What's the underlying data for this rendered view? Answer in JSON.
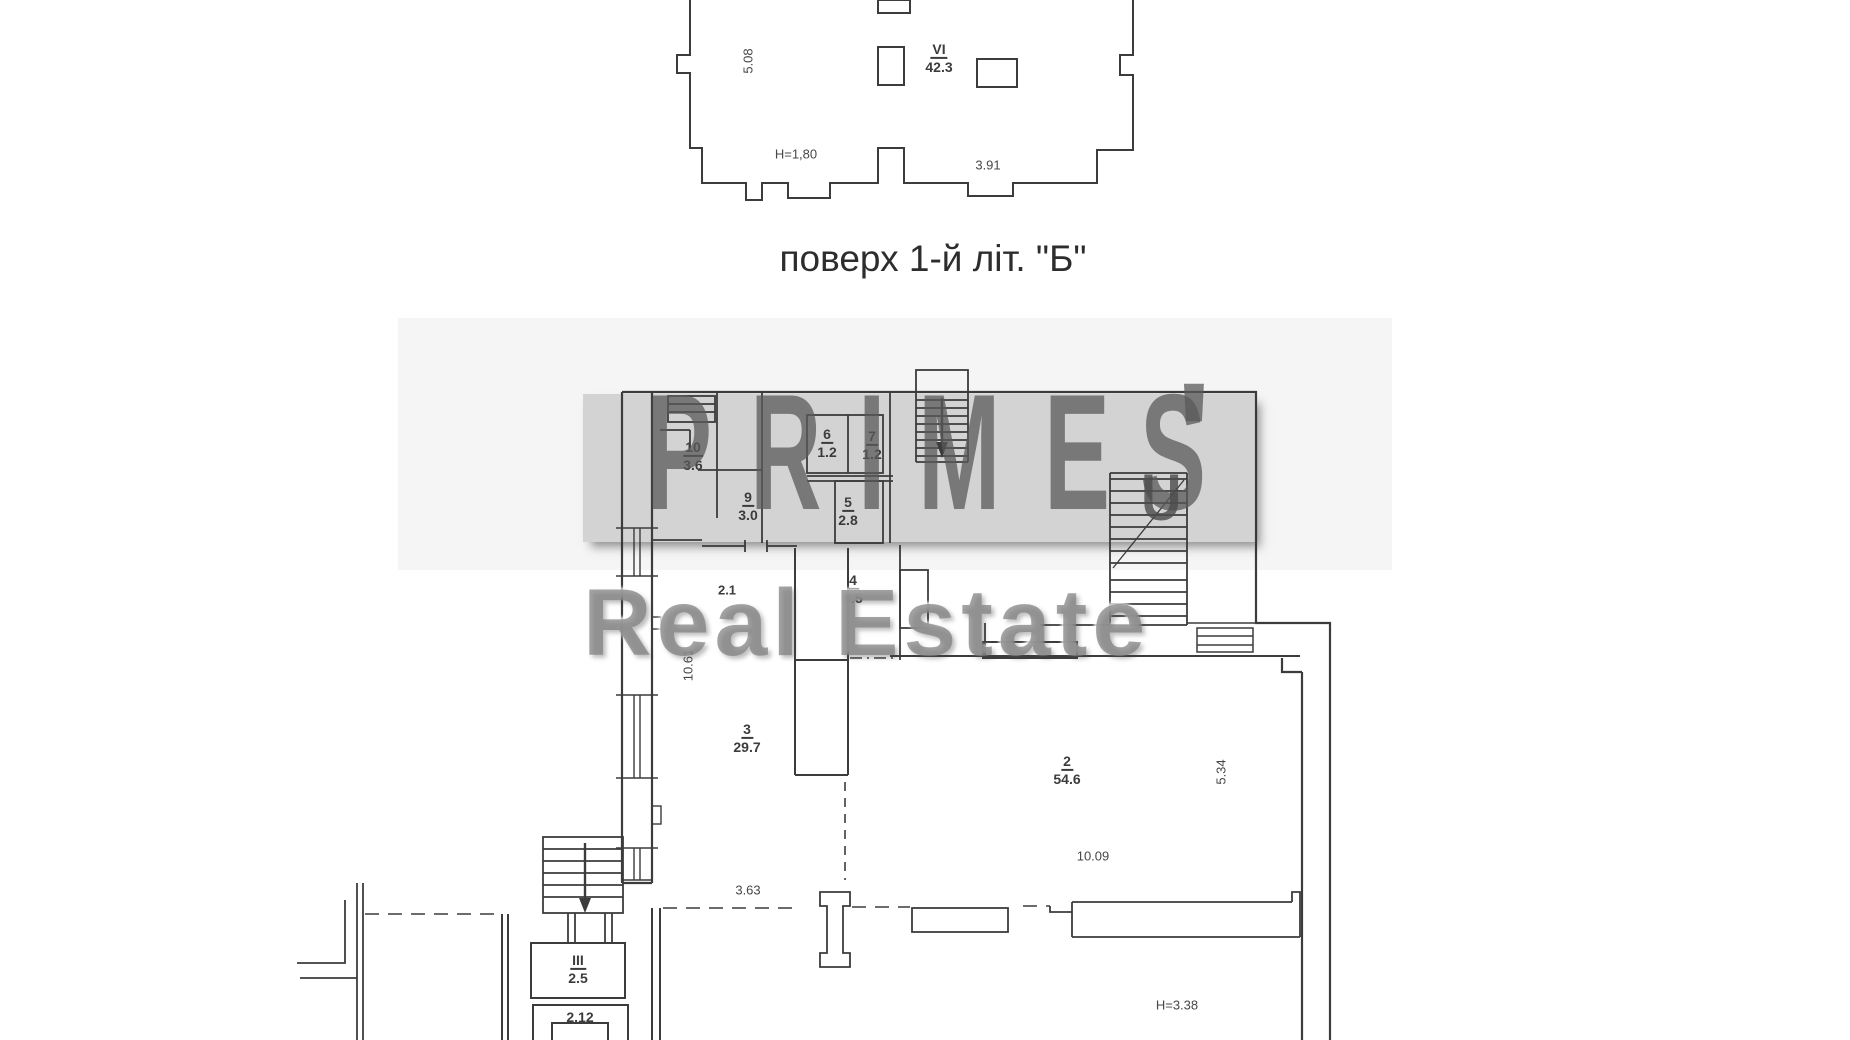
{
  "scan": {
    "upper_plan": {
      "title": "поверх 1-й літ. \"Б\"",
      "room": {
        "num": "VI",
        "area": "42.3"
      },
      "dims": {
        "side": "5.08",
        "height": "H=1,80",
        "bottom": "3.91"
      }
    },
    "lower_plan": {
      "rooms": [
        {
          "num": "10",
          "area": "3.6"
        },
        {
          "num": "9",
          "area": "3.0"
        },
        {
          "num": "6",
          "area": "1.2"
        },
        {
          "num": "7",
          "area": "1.2"
        },
        {
          "num": "5",
          "area": "2.8"
        },
        {
          "num": "4",
          "area": "4.5"
        },
        {
          "num": "3",
          "area": "29.7"
        },
        {
          "num": "2",
          "area": "54.6"
        },
        {
          "num": "III",
          "area": "2.5"
        }
      ],
      "labels": {
        "vestibule": "2.12",
        "partial": "2.1"
      },
      "dims": {
        "left_height": "10.61",
        "bottom_left": "3.63",
        "right_side": "5.34",
        "room2_width": "10.09",
        "ceiling_height": "H=3.38"
      }
    }
  },
  "watermark": {
    "brand_letters": [
      "P",
      "R",
      "I",
      "M",
      "E",
      "S"
    ],
    "apostrophe": "'",
    "extra_glyph": "U",
    "subtitle": "Real Estate"
  },
  "colors": {
    "plan_line": "#3c3c3c",
    "watermark_gray": "#d6d6d6",
    "text": "#2d2d2d"
  }
}
